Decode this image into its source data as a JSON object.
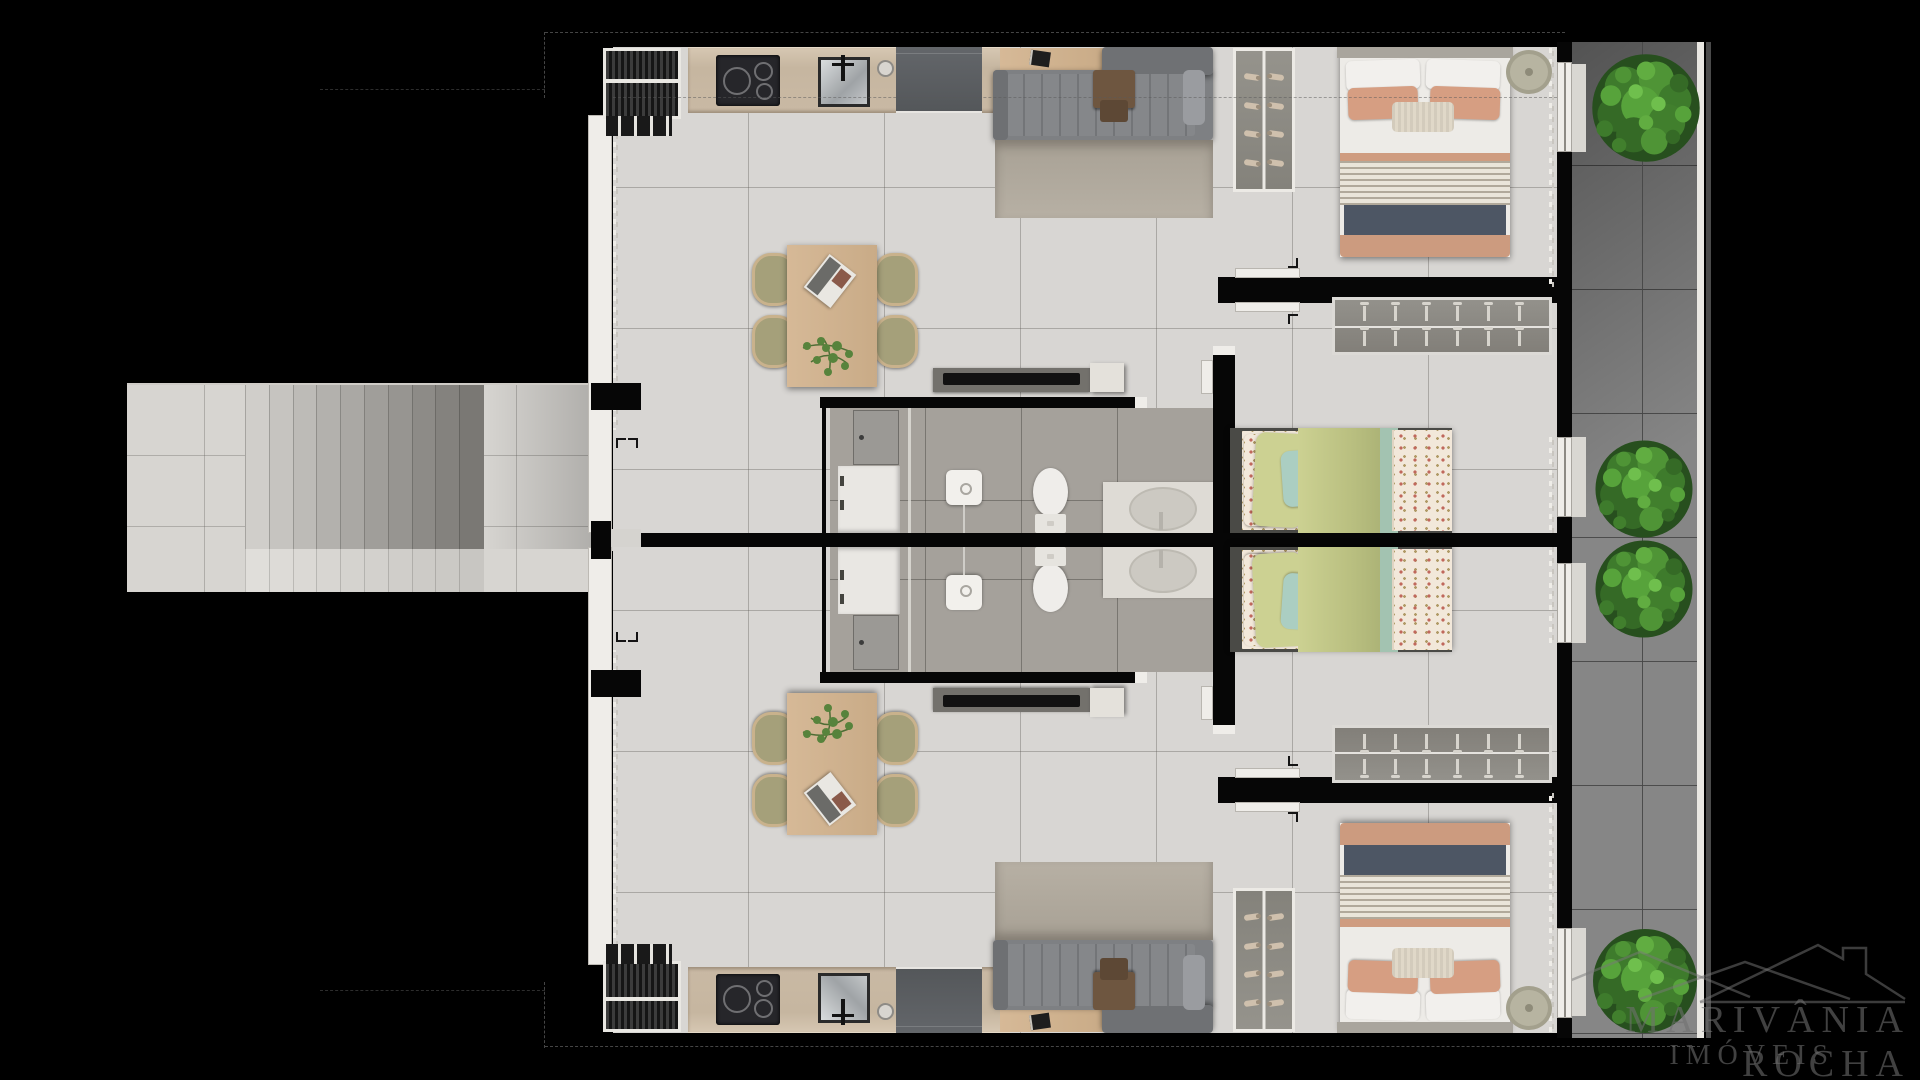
{
  "watermark": {
    "title": "MARIVÂNIA ROCHA",
    "subtitle": "IMÓVEIS"
  },
  "palette": {
    "background": "#000000",
    "floor_tile": "#d8d6d3",
    "bathroom_tile": "#a5a19b",
    "balcony_tile": "#868686",
    "wall": "#060606",
    "counter_stone": "#c9b9a4",
    "sofa_gray": "#7e8083",
    "wood": "#d2b28c",
    "chair_olive": "#a5a07a",
    "pillow_salmon": "#d69e82",
    "duvet_navy": "#4d5664",
    "bedding_green": "#ccd192",
    "bedding_teal": "#abcec2",
    "plant_green": "#4f9436",
    "watermark_gray": "#707070"
  },
  "scene": {
    "type": "apartment-floor-plan-top-view-render",
    "units": [
      "unit-top",
      "unit-bottom-mirrored"
    ],
    "rooms_per_unit": [
      "kitchen",
      "living-dining",
      "bathroom-laundry",
      "bedroom-1",
      "bedroom-2",
      "entry"
    ],
    "shared_areas": [
      "stairwell",
      "balcony"
    ],
    "furniture_per_unit": [
      "ac-grille",
      "induction-cooktop",
      "kitchen-sink",
      "refrigerator",
      "console-table",
      "sofa",
      "rug",
      "shoe-rack",
      "dining-table",
      "dining-chairs",
      "bench",
      "stool",
      "washing-machine",
      "shower",
      "toilet",
      "vanity-sink",
      "double-bed",
      "round-side-table",
      "clothes-rail",
      "single-bed",
      "curtains",
      "sliding-doors"
    ]
  },
  "counts": {
    "units": 2,
    "stair_steps_per_flight": 10,
    "dining_chairs_per_unit": 4,
    "shoe_rack_rows": 4,
    "shoes_per_row": 2,
    "hanger_rows": 2,
    "hangers_per_row": 6,
    "balcony_plants": 4,
    "cooktop_rings": 3
  }
}
